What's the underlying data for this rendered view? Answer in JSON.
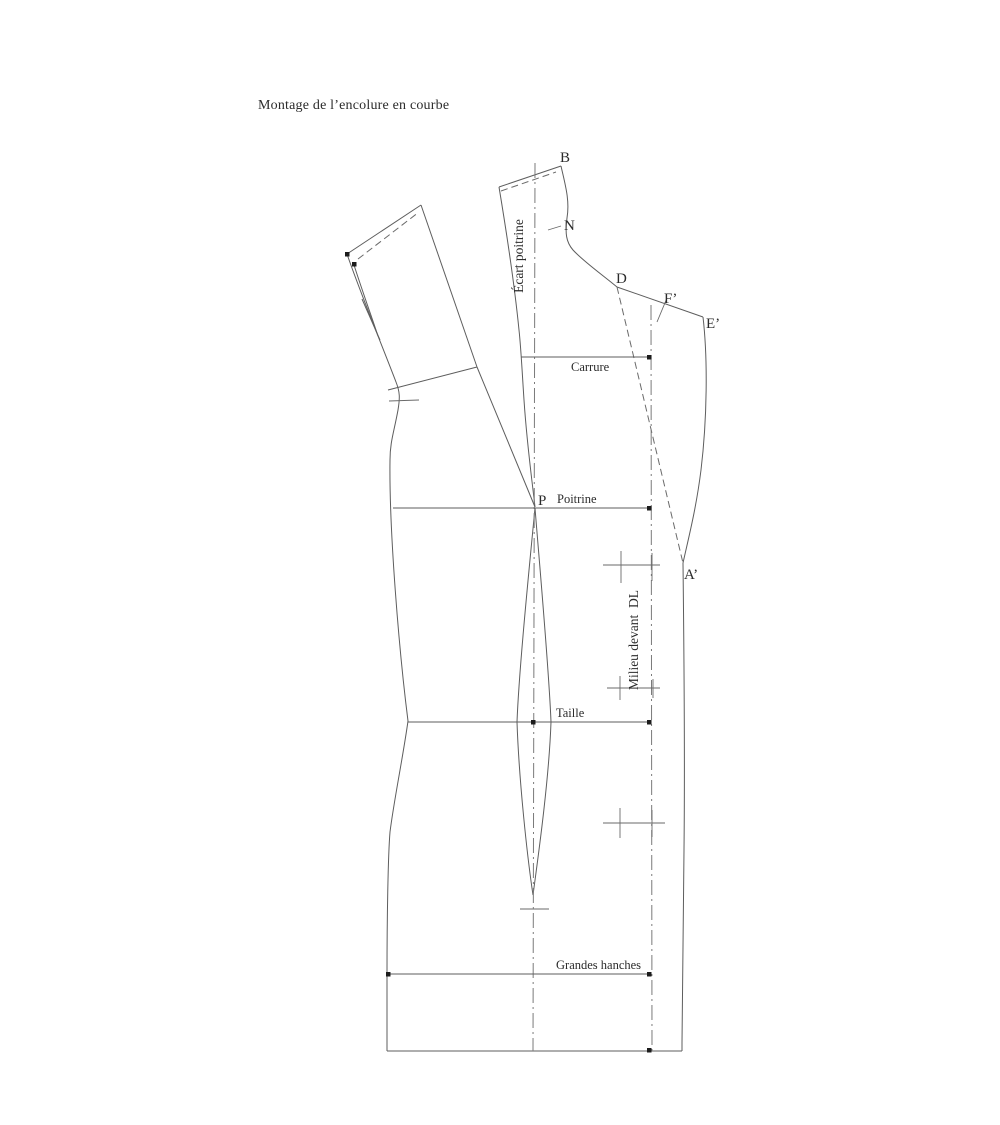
{
  "title": "Montage de l’encolure en courbe",
  "labels": {
    "points": {
      "b": "B",
      "n": "N",
      "d": "D",
      "f_prime": "F’",
      "e_prime": "E’",
      "a_prime": "A’",
      "p": "P"
    },
    "lines": {
      "carrure": "Carrure",
      "poitrine": "Poitrine",
      "taille": "Taille",
      "grandes_hanches": "Grandes hanches"
    },
    "rotated": {
      "ecart_poitrine": "Écart poitrine",
      "milieu_devant": "Milieu devant  DL"
    }
  },
  "colors": {
    "background": "#ffffff",
    "outline": "#5d5d5d",
    "axis": "#7a7a7a",
    "marker": "#1c1c1c",
    "text": "#2b2b2b"
  }
}
